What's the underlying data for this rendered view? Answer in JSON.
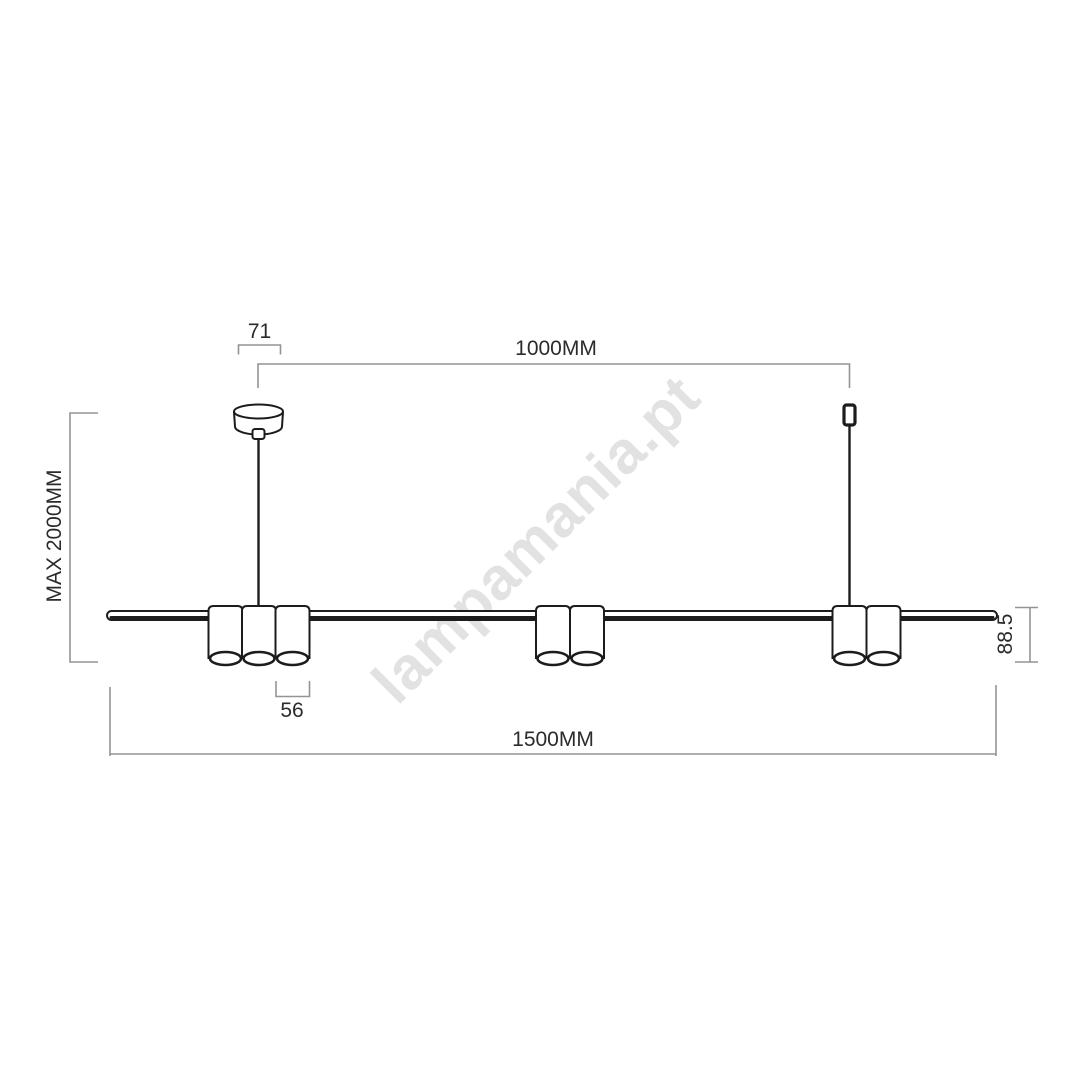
{
  "watermark": {
    "text": "lampamania.pt"
  },
  "dimensions": {
    "canopy_width": "71",
    "suspension_span": "1000MM",
    "max_height": "MAX 2000MM",
    "shade_diameter": "56",
    "shade_height": "88.5",
    "bar_length": "1500MM"
  },
  "colors": {
    "outline": "#1c1c1c",
    "dimension_line": "#949494",
    "dimension_text": "#2b2b2b",
    "watermark": "#e2e2e2",
    "background": "#ffffff"
  }
}
